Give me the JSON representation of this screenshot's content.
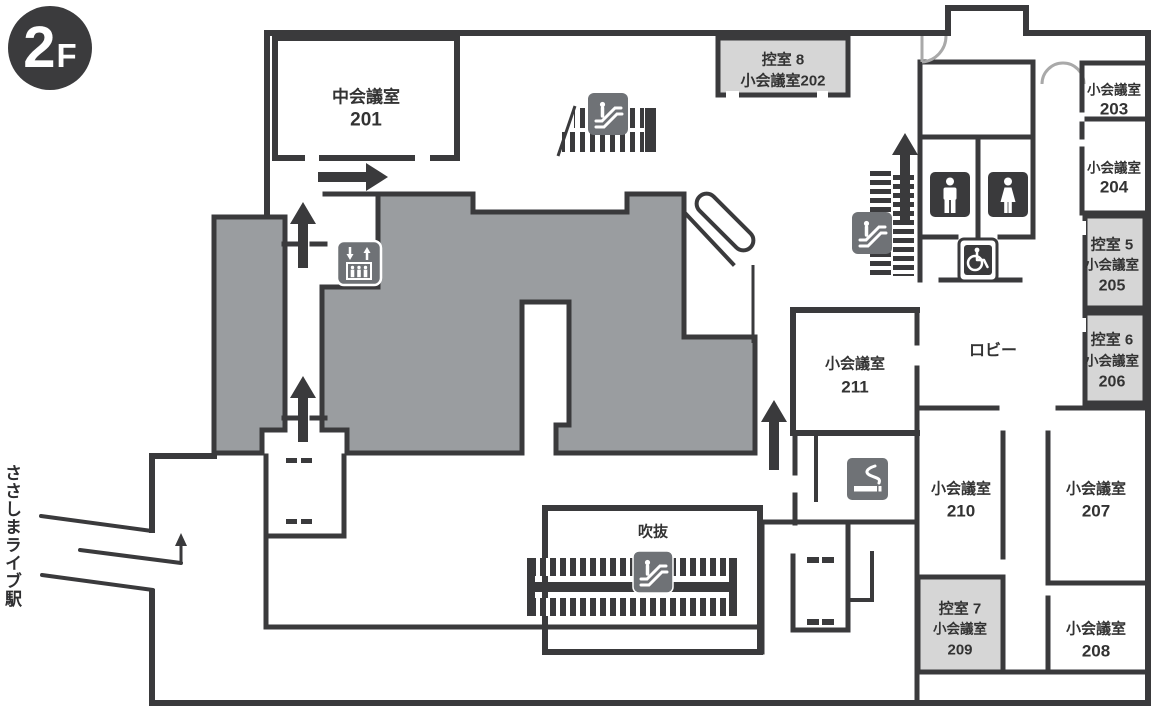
{
  "floor_badge": {
    "number": "2",
    "suffix": "F"
  },
  "station": {
    "label": "ささしまライブ駅"
  },
  "areas": {
    "lobby": "ロビー",
    "atrium": "吹抜"
  },
  "rooms": {
    "r201": {
      "name": "中会議室",
      "number": "201"
    },
    "r202": {
      "line1": "控室 8",
      "line2": "小会議室202"
    },
    "r203": {
      "name": "小会議室",
      "number": "203"
    },
    "r204": {
      "name": "小会議室",
      "number": "204"
    },
    "r205": {
      "line1": "控室 5",
      "line2": "小会議室",
      "number": "205"
    },
    "r206": {
      "line1": "控室 6",
      "line2": "小会議室",
      "number": "206"
    },
    "r207": {
      "name": "小会議室",
      "number": "207"
    },
    "r208": {
      "name": "小会議室",
      "number": "208"
    },
    "r209": {
      "line1": "控室 7",
      "line2": "小会議室",
      "number": "209"
    },
    "r210": {
      "name": "小会議室",
      "number": "210"
    },
    "r211": {
      "name": "小会議室",
      "number": "211"
    }
  },
  "icons": {
    "escalator": "escalator-icon",
    "elevator": "elevator-icon",
    "stairs": "stairs",
    "mens_toilet": "mens-toilet-icon",
    "womens_toilet": "womens-toilet-icon",
    "wheelchair": "wheelchair-accessible-icon",
    "smoking": "smoking-area-icon"
  },
  "colors": {
    "wall": "#3a3a3c",
    "hall_fill": "#9a9da0",
    "room_fill": "#d6d6d6",
    "icon_bg": "#6f7276",
    "door_arc": "#a9a9a9",
    "text": "#333333",
    "badge_bg": "#3b3b3d"
  }
}
